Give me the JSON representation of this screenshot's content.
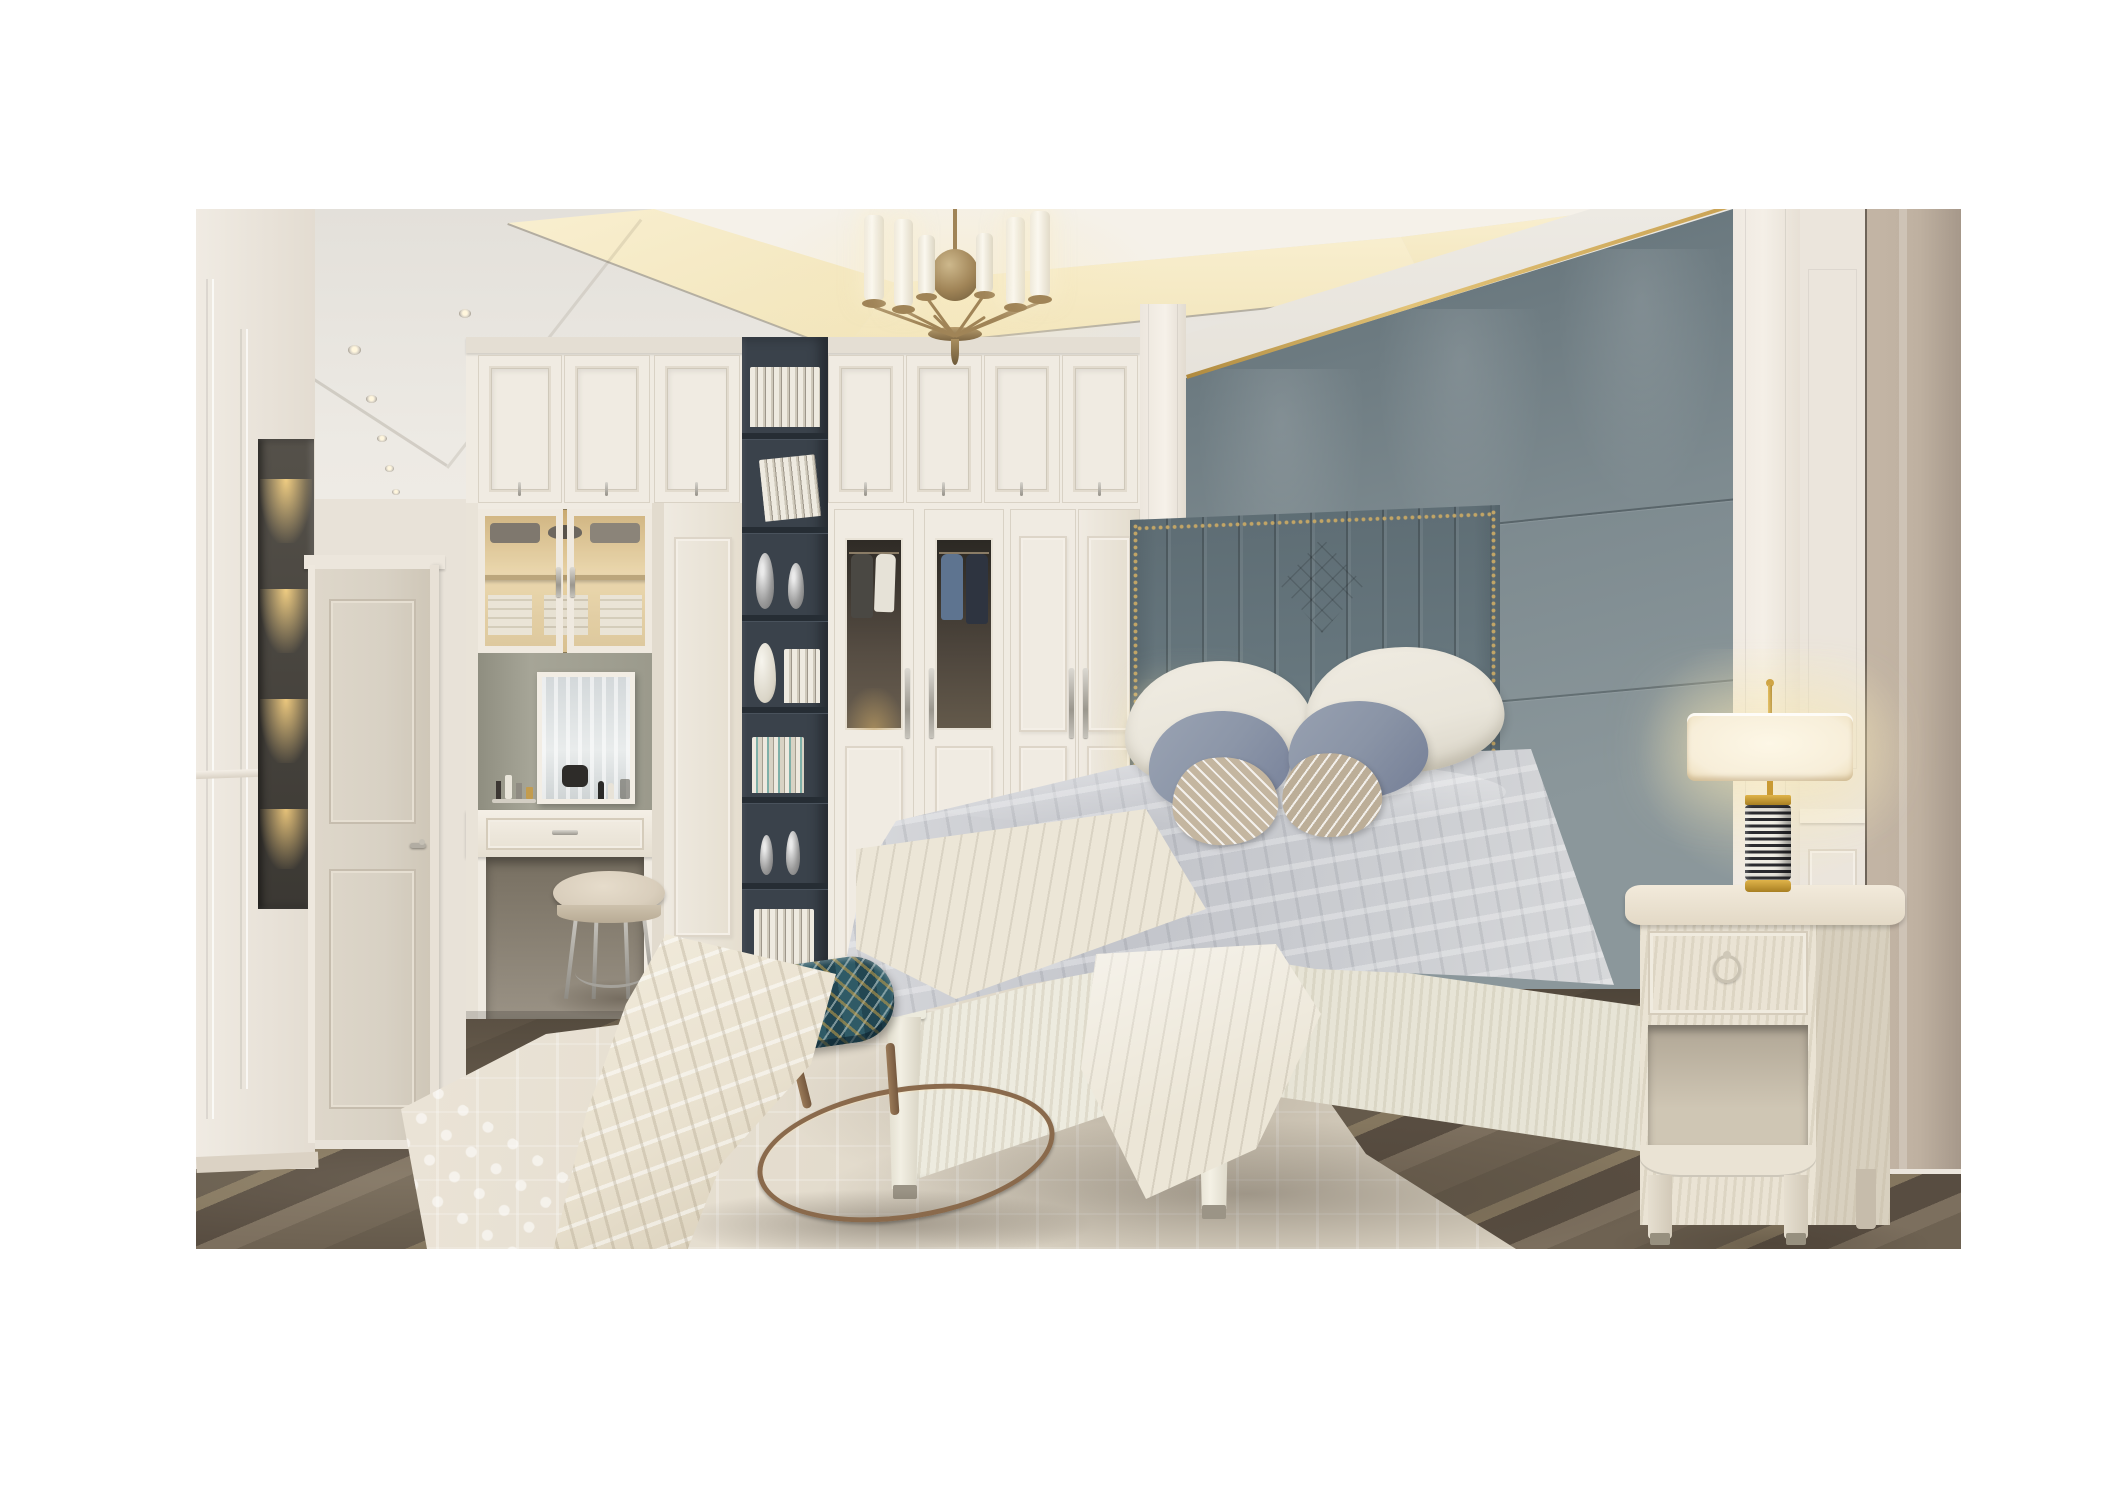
{
  "meta": {
    "type": "photorealistic 3d interior rendering",
    "description": "Luxury neoclassical bedroom rendering: white paneled walls and wardrobes, gray-blue upholstered accent wall with gold trim, channel-tufted headboard bed with layered gray and striped pillows, cream throws, brass chandelier with white candle shades, recessed ceiling cove lighting, dark charcoal bookshelf column with books and silver vases, built-in vanity with mirror and stool, patterned teal-gold bench on bronze hoop base, two cream nightstands with black-and-white striped gold table lamps, cream patterned rug over dark wood plank floor, hallway with paneled door and lit display niche."
  },
  "scene": {
    "room": "master bedroom",
    "style": "modern neoclassical / light luxury",
    "lighting": [
      "warm ceiling cove strip",
      "recessed spotlights",
      "brass 8-arm chandelier",
      "two lit table lamps",
      "lit wardrobe display case",
      "lit hallway display niche"
    ],
    "objects": [
      "coffered ceiling with warm cove lighting",
      "brass chandelier with cylindrical white shades",
      "recessed ceiling spotlights",
      "gray-blue upholstered accent wall with brass trim strip",
      "channel-tufted wing headboard with nailhead trim",
      "bed with gray duvet, white pillows, blue-gray pillows, striped tan pillows",
      "cream throw blankets",
      "white wood bed frame with tapered posts",
      "white wardrobe wall with paneled and glass doors",
      "glass wardrobe doors showing hanging shirts",
      "charcoal open bookshelf column with books and silver vases",
      "built-in vanity with mirror, cosmetics and upholstered stool",
      "lit display cabinet with folded clothes and hats",
      "teal and gold patterned bench with bronze hoop base",
      "two cream nightstands with ring pulls",
      "two table lamps with striped bodies and cream drum shades",
      "cream patterned area rug",
      "dark walnut plank flooring",
      "hallway with two-panel door and lit shelf niche",
      "white wall paneling and pilasters"
    ]
  },
  "palette": {
    "canvas": "#ffffff",
    "wall": "#ebe5dc",
    "wall_shadow": "#ddd6cb",
    "ceiling": "#e6e3dd",
    "ceiling_tray": "#f5f1e9",
    "cove_glow": "#f1e4b9",
    "cove_glow_bright": "#f9efd0",
    "hall_wall": "#e8e2d8",
    "door": "#d8d1c4",
    "gray_panel_dark": "#5f6e75",
    "gray_panel": "#7e8b90",
    "gray_panel_light": "#8b979b",
    "gold_trim": "#c9a254",
    "headboard": "#66767d",
    "headboard_dark": "#55646b",
    "nailhead": "#c2a566",
    "wardrobe": "#f0ebe2",
    "wardrobe_shadow": "#ded7ca",
    "shelf_dark": "#3a424b",
    "shelf_darker": "#262d34",
    "bedding_gray": "#c3c5cb",
    "bedding_gray_light": "#dcdde0",
    "sheet_cream": "#ece6d7",
    "throw_cream": "#e9e1cf",
    "pillow_white": "#e9e5da",
    "pillow_blue": "#8c96a8",
    "pillow_tan": "#c4b6a0",
    "bedframe": "#edebdf",
    "nightstand": "#eae3d4",
    "nightstand_side": "#d8d0bf",
    "nightstand_recess": "#b0a695",
    "lamp_shade": "#f7eed9",
    "lamp_gold": "#c99a33",
    "lamp_stripe_dark": "#2b2b2f",
    "lamp_stripe_light": "#f0ede4",
    "bench_teal": "#2f5a66",
    "bench_gold": "#c39c4e",
    "bench_bronze": "#8a6a4c",
    "stool_leather": "#d9cebc",
    "rug": "#e8e1d3",
    "floor_1": "#6e6252",
    "floor_2": "#7c6f5e",
    "floor_3": "#584d41",
    "floor_4": "#85775f",
    "pilaster_edge": "#c3b5a5",
    "pilaster_edge_dark": "#a6988a",
    "brass": "#a08457",
    "candle": "#fbf8ef"
  }
}
